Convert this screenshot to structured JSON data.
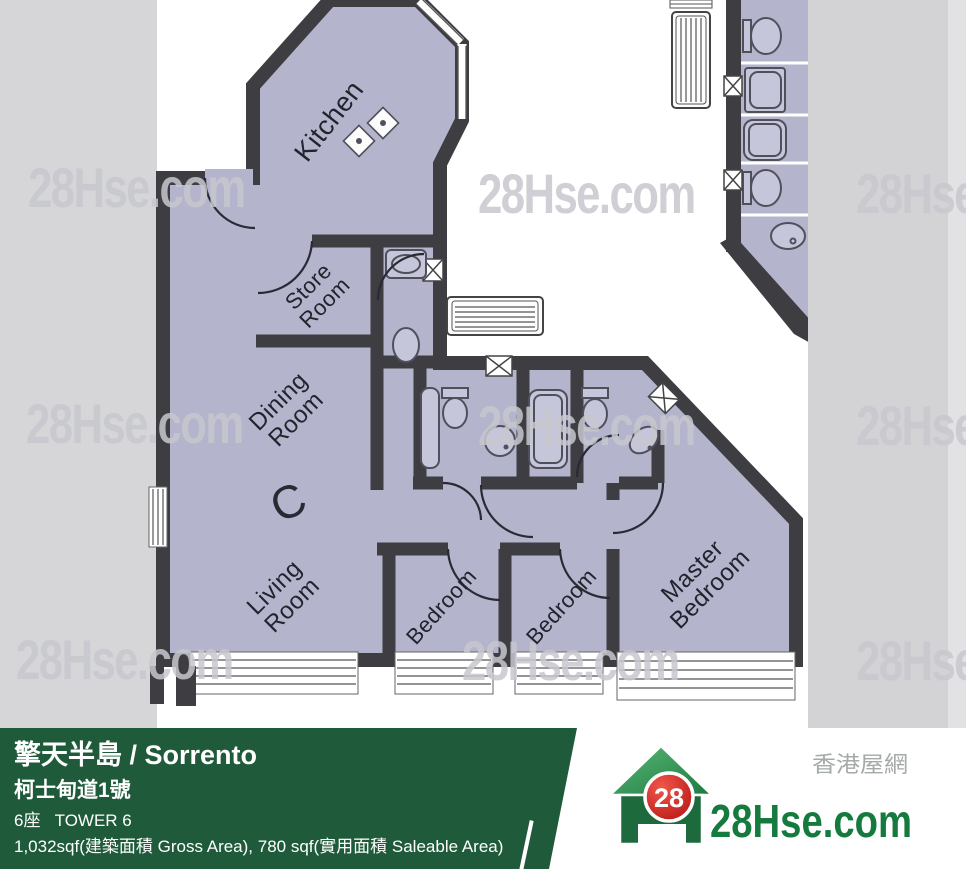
{
  "watermark": {
    "text": "28Hse.com"
  },
  "floorplan": {
    "unit_label": "C",
    "floor_color": "#b4b4cc",
    "wall_color": "#3d3d42",
    "rooms": [
      {
        "label": "Kitchen"
      },
      {
        "label": "Store\nRoom"
      },
      {
        "label": "Dining\nRoom"
      },
      {
        "label": "Living\nRoom"
      },
      {
        "label": "Bedroom"
      },
      {
        "label": "Bedroom"
      },
      {
        "label": "Master\nBedroom"
      }
    ]
  },
  "info_panel": {
    "background_color": "#1f5b3a",
    "building_name": "擎天半島 / Sorrento",
    "address": "柯士甸道1號",
    "tower": "6座   TOWER 6",
    "area": "1,032sqf(建築面積 Gross Area), 780 sqf(實用面積 Saleable Area)"
  },
  "logo": {
    "badge_number": "28",
    "site_name": "28Hse.com",
    "chinese_name": "香港屋網",
    "green": "#157a3e",
    "red": "#c81d1d"
  }
}
